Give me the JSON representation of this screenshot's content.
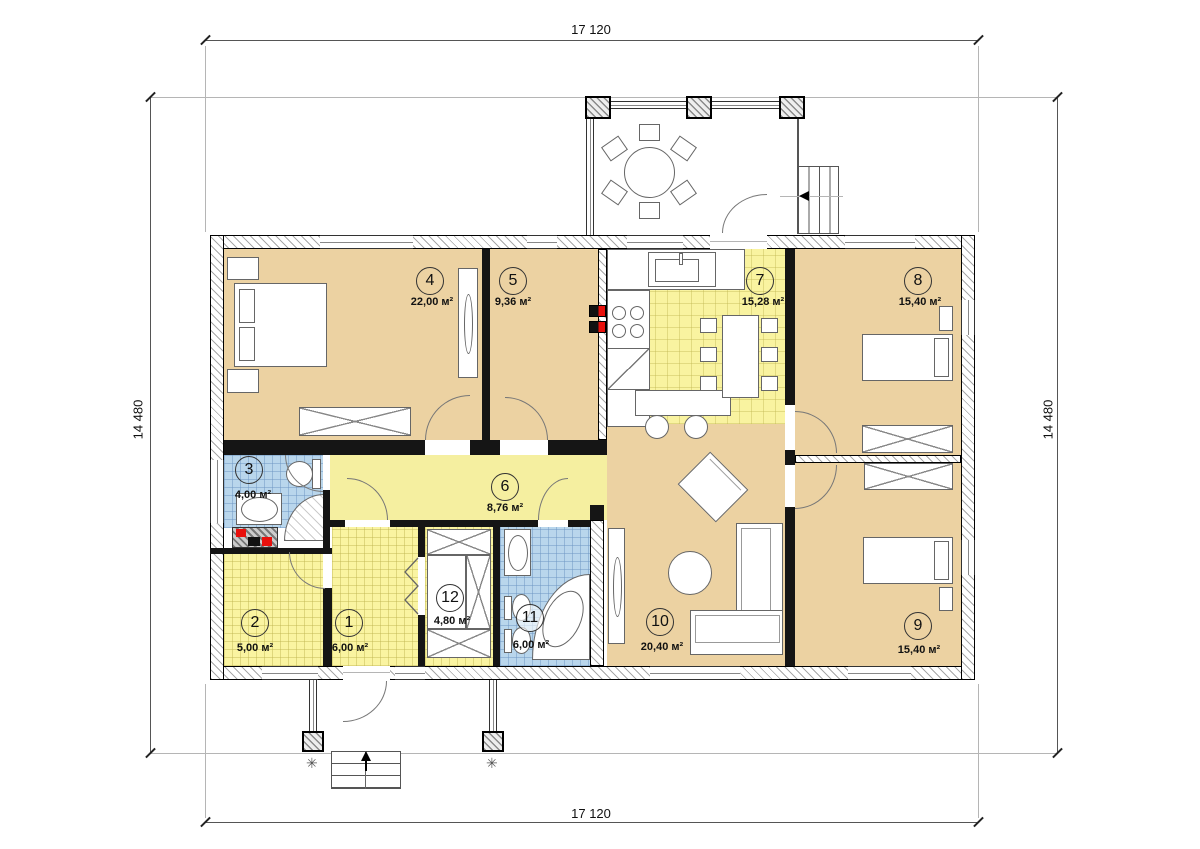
{
  "dimensions": {
    "top": "17 120",
    "bottom": "17 120",
    "left": "14 480",
    "right": "14 480"
  },
  "rooms": {
    "1": {
      "number": "1",
      "area": "6,00 м²"
    },
    "2": {
      "number": "2",
      "area": "5,00 м²"
    },
    "3": {
      "number": "3",
      "area": "4,00 м²"
    },
    "4": {
      "number": "4",
      "area": "22,00 м²"
    },
    "5": {
      "number": "5",
      "area": "9,36 м²"
    },
    "6": {
      "number": "6",
      "area": "8,76 м²"
    },
    "7": {
      "number": "7",
      "area": "15,28 м²"
    },
    "8": {
      "number": "8",
      "area": "15,40 м²"
    },
    "9": {
      "number": "9",
      "area": "15,40 м²"
    },
    "10": {
      "number": "10",
      "area": "20,40 м²"
    },
    "11": {
      "number": "11",
      "area": "6,00 м²"
    },
    "12": {
      "number": "12",
      "area": "4,80 м²"
    }
  },
  "colors": {
    "room_tan": "#ecd2a2",
    "tile_yellow": "#faf4a1",
    "corridor_yellow": "#f5efa0",
    "tile_blue": "#b9d6ec",
    "accent_red": "#e8100c",
    "wall": "#151515"
  }
}
